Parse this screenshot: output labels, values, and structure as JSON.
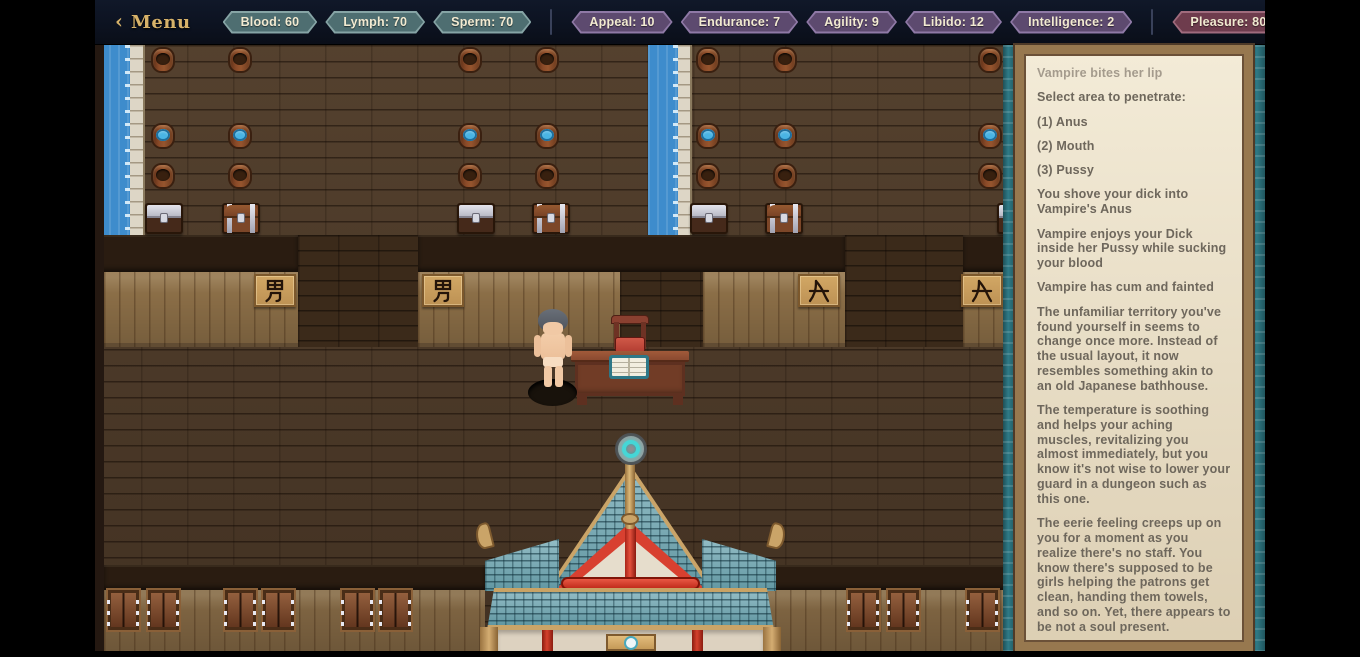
{
  "topbar": {
    "back_icon": "‹",
    "menu_label": "Menu",
    "help_label": "?",
    "stat_groups": [
      {
        "name": "vitals",
        "badges": [
          "Blood: 60",
          "Lymph: 70",
          "Sperm: 70"
        ]
      },
      {
        "name": "attributes",
        "badges": [
          "Appeal: 10",
          "Endurance: 7",
          "Agility: 9",
          "Libido: 12",
          "Intelligence: 2"
        ]
      },
      {
        "name": "pleasure",
        "badges": [
          "Pleasure: 80"
        ]
      }
    ]
  },
  "colors": {
    "menu_gold": "#d7b269",
    "vitals_badge": "#4e6e71",
    "attributes_badge": "#5d4a6f",
    "pleasure_badge": "#6e3c4d",
    "badge_text": "#f2ead1",
    "sidebar_bg": "#e7dcc3",
    "log_text": "#6e675c",
    "log_muted": "#a49b8d"
  },
  "log": {
    "entries": [
      {
        "text": "Vampire bites her lip",
        "muted": true
      },
      {
        "text": "Select area to penetrate:"
      },
      {
        "text": "(1) Anus"
      },
      {
        "text": "(2) Mouth"
      },
      {
        "text": "(3) Pussy"
      },
      {
        "text": "You shove your dick into Vampire's Anus"
      },
      {
        "text": "Vampire enjoys your Dick inside her Pussy while sucking your blood"
      },
      {
        "text": "Vampire has cum and fainted"
      },
      {
        "text": "The unfamiliar territory you've found yourself in seems to change once more. Instead of the usual layout, it now resembles something akin to an old Japanese bathhouse."
      },
      {
        "text": "The temperature is soothing and helps your aching muscles, revitalizing you almost immediately, but you know it's not wise to lower your guard in a dungeon such as this one."
      },
      {
        "text": "The eerie feeling creeps up on you for a moment as you realize there's no staff. You know there's supposed to be girls helping the patrons get clean, handing them towels, and so on. Yet, there appears to be not a soul present."
      },
      {
        "text": "You feel strangely, like you are being blown around by a gentle wind"
      }
    ]
  },
  "scene": {
    "signs": [
      {
        "char": "男",
        "x": 159,
        "y": 229
      },
      {
        "char": "男",
        "x": 327,
        "y": 229
      },
      {
        "char": "女",
        "x": 703,
        "y": 229
      },
      {
        "char": "女",
        "x": 866,
        "y": 229
      }
    ],
    "barrels": [
      {
        "x": 56,
        "y": 2,
        "water": false
      },
      {
        "x": 133,
        "y": 2,
        "water": false
      },
      {
        "x": 363,
        "y": 2,
        "water": false
      },
      {
        "x": 440,
        "y": 2,
        "water": false
      },
      {
        "x": 601,
        "y": 2,
        "water": false
      },
      {
        "x": 678,
        "y": 2,
        "water": false
      },
      {
        "x": 883,
        "y": 2,
        "water": false
      },
      {
        "x": 56,
        "y": 78,
        "water": true
      },
      {
        "x": 133,
        "y": 78,
        "water": true
      },
      {
        "x": 363,
        "y": 78,
        "water": true
      },
      {
        "x": 440,
        "y": 78,
        "water": true
      },
      {
        "x": 601,
        "y": 78,
        "water": true
      },
      {
        "x": 678,
        "y": 78,
        "water": true
      },
      {
        "x": 883,
        "y": 78,
        "water": true
      },
      {
        "x": 56,
        "y": 118,
        "water": false
      },
      {
        "x": 133,
        "y": 118,
        "water": false
      },
      {
        "x": 363,
        "y": 118,
        "water": false
      },
      {
        "x": 440,
        "y": 118,
        "water": false
      },
      {
        "x": 601,
        "y": 118,
        "water": false
      },
      {
        "x": 678,
        "y": 118,
        "water": false
      },
      {
        "x": 883,
        "y": 118,
        "water": false
      }
    ],
    "chests": [
      {
        "x": 50,
        "y": 158,
        "variant": "silver"
      },
      {
        "x": 127,
        "y": 158,
        "variant": "banded"
      },
      {
        "x": 362,
        "y": 158,
        "variant": "silver"
      },
      {
        "x": 437,
        "y": 158,
        "variant": "banded"
      },
      {
        "x": 595,
        "y": 158,
        "variant": "silver"
      },
      {
        "x": 670,
        "y": 158,
        "variant": "banded"
      },
      {
        "x": 902,
        "y": 158,
        "variant": "silver"
      }
    ],
    "shutters": [
      {
        "x": 13,
        "y": 545
      },
      {
        "x": 53,
        "y": 545
      },
      {
        "x": 130,
        "y": 545
      },
      {
        "x": 168,
        "y": 545
      },
      {
        "x": 247,
        "y": 545
      },
      {
        "x": 285,
        "y": 545
      },
      {
        "x": 753,
        "y": 545
      },
      {
        "x": 793,
        "y": 545
      },
      {
        "x": 872,
        "y": 545
      },
      {
        "x": 910,
        "y": 545
      }
    ]
  }
}
